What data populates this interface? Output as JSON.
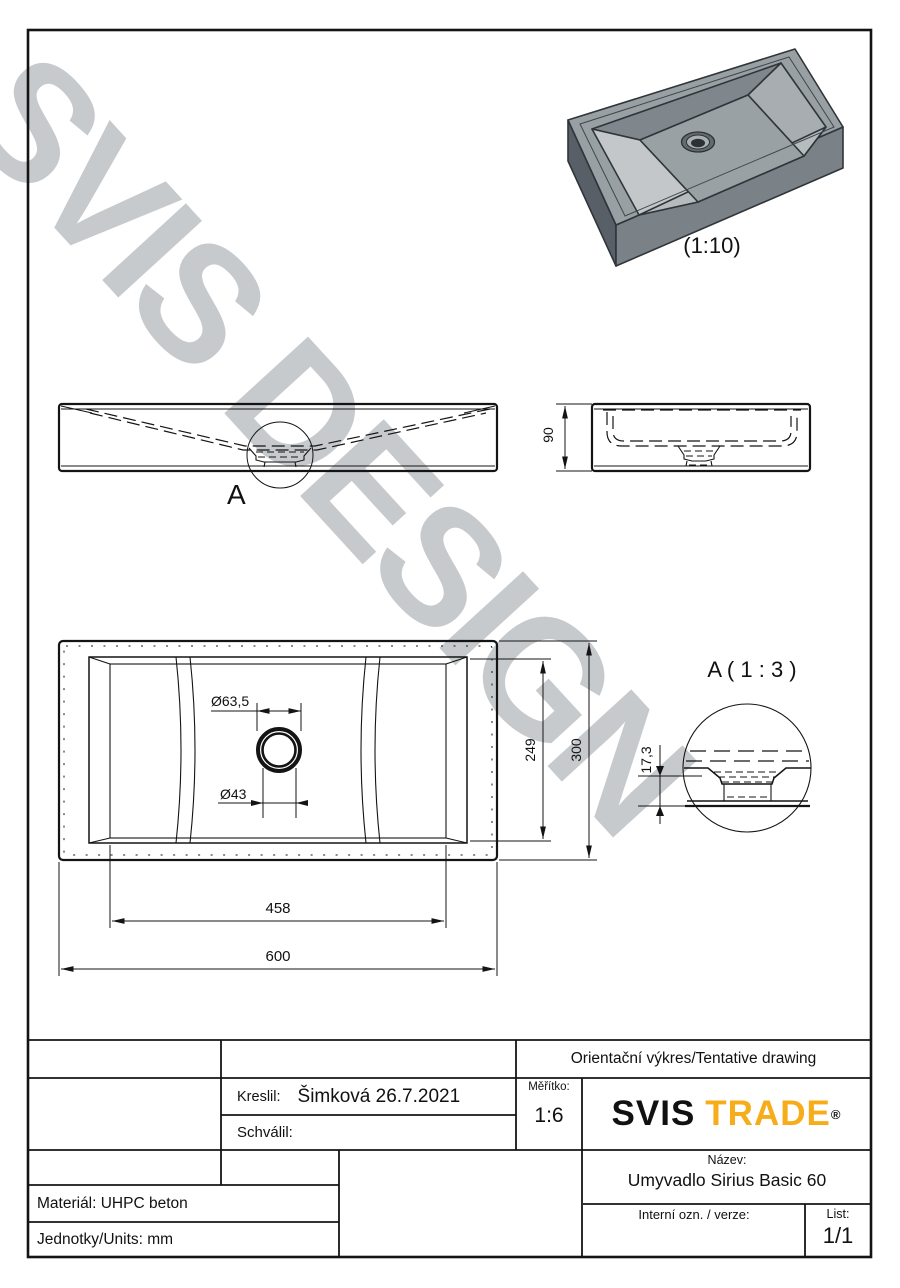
{
  "accent": "#F7AD19",
  "watermark": "SVIS DESIGN",
  "labels": {
    "iso_scale": "(1:10)",
    "detail_mark": "A",
    "detail_title": "A ( 1 : 3 )"
  },
  "dims": {
    "height": "90",
    "depth_outer": "300",
    "depth_inner": "249",
    "width_inner": "458",
    "width_outer": "600",
    "drain_outer": "Ø63,5",
    "drain_hole": "Ø43",
    "detail_height": "17,3"
  },
  "title_block": {
    "tentative": "Orientační výkres/Tentative drawing",
    "drawn_label": "Kreslil:",
    "drawn_value": "Šimková 26.7.2021",
    "approved_label": "Schválil:",
    "scale_label": "Měřítko:",
    "scale_value": "1:6",
    "logo_svis": "SVIS",
    "logo_trade": "TRADE",
    "logo_reg": "®",
    "name_label": "Název:",
    "name_value": "Umyvadlo Sirius Basic 60",
    "internal_label": "Interní ozn. / verze:",
    "sheet_label": "List:",
    "sheet_value": "1/1",
    "material": "Materiál: UHPC beton",
    "units": "Jednotky/Units: mm"
  }
}
